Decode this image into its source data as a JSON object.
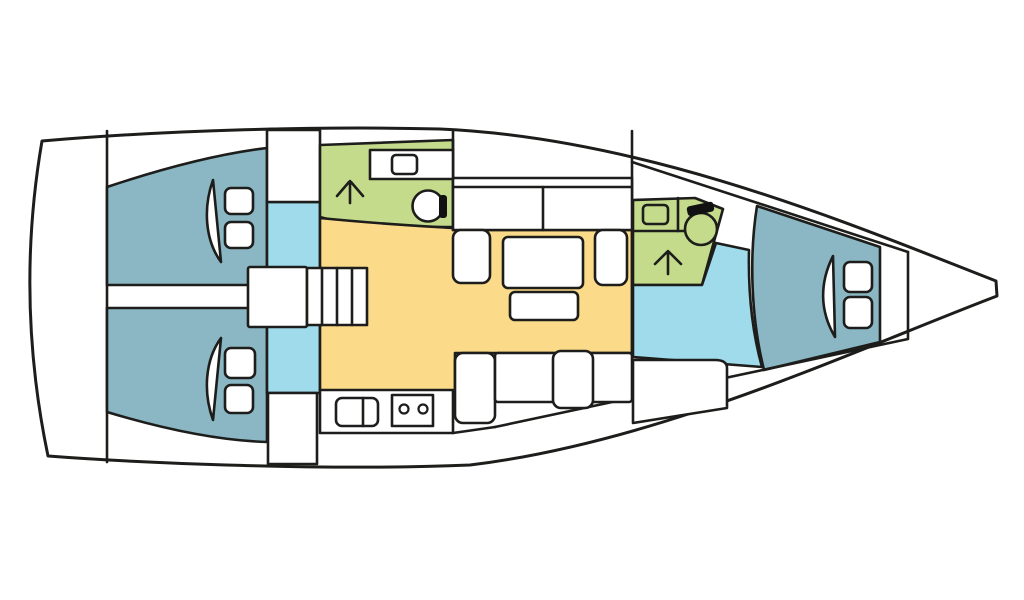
{
  "diagram": {
    "title": "sailboat-interior-layout-top-view",
    "canvas": {
      "width": 1024,
      "height": 600,
      "background": "#ffffff"
    },
    "palette": {
      "line": "#1d1d1b",
      "hull": "#ffffff",
      "cabin": "#8ab7c3",
      "corridor": "#9fdbea",
      "head": "#c4db8c",
      "salon": "#fbda89",
      "fixture": "#ffffff",
      "tank": "#111111"
    },
    "rooms": [
      {
        "name": "aft-cabin-port",
        "fill": "cabin"
      },
      {
        "name": "aft-cabin-starboard",
        "fill": "cabin"
      },
      {
        "name": "forward-cabin",
        "fill": "cabin"
      },
      {
        "name": "aft-head",
        "fill": "head"
      },
      {
        "name": "forward-head",
        "fill": "head"
      },
      {
        "name": "saloon",
        "fill": "salon"
      },
      {
        "name": "companionway-corridor",
        "fill": "corridor"
      },
      {
        "name": "forward-corridor",
        "fill": "corridor"
      }
    ],
    "shapes": [
      {
        "n": "hull-outline",
        "t": "path",
        "f": "hull",
        "w": 3,
        "a": {
          "d": "M 42 141 C 170 130 320 126 440 129 C 650 138 860 228 996 281 L 997 296 C 850 352 660 442 470 465 C 330 471 140 463 48 456 Q 15 298 42 141 Z"
        }
      },
      {
        "n": "stern-bulkhead-line",
        "t": "line",
        "a": {
          "x1": 107,
          "y1": 131,
          "x2": 107,
          "y2": 462
        }
      },
      {
        "n": "aft-cabin-port-area",
        "t": "path",
        "f": "cabin",
        "a": {
          "d": "M 107 187 Q 200 156 267 148 L 267 285 L 107 285 Z"
        }
      },
      {
        "n": "aft-cabin-starboard-area",
        "t": "path",
        "f": "cabin",
        "a": {
          "d": "M 107 412 Q 200 440 267 442 L 267 308 L 107 308 Z"
        }
      },
      {
        "n": "companionway-corridor-area",
        "t": "rect",
        "f": "corridor",
        "a": {
          "x": 267,
          "y": 202,
          "width": 53,
          "height": 191
        }
      },
      {
        "n": "wet-locker-top",
        "t": "rect",
        "f": "hull",
        "a": {
          "x": 267,
          "y": 130,
          "width": 53,
          "height": 72
        }
      },
      {
        "n": "wet-locker-bottom",
        "t": "rect",
        "f": "hull",
        "a": {
          "x": 268,
          "y": 393,
          "width": 49,
          "height": 71
        }
      },
      {
        "n": "aft-head-area",
        "t": "path",
        "f": "head",
        "a": {
          "d": "M 320 145 L 453 140 L 453 227 L 357 227 L 320 217 Z"
        }
      },
      {
        "n": "saloon-area",
        "t": "path",
        "f": "salon",
        "a": {
          "d": "M 320 218 C 380 224 420 226 453 228 L 453 230 L 632 230 L 632 353 L 455 353 L 455 392 L 320 392 Z"
        }
      },
      {
        "n": "forward-head-area",
        "t": "path",
        "f": "head",
        "a": {
          "d": "M 633 200 L 695 198 L 723 209 L 702 285 L 633 285 Z"
        }
      },
      {
        "n": "forward-corridor-area",
        "t": "path",
        "f": "corridor",
        "a": {
          "d": "M 633 285 L 702 285 L 716 243 L 749 250 C 748 295 753 335 762 367 L 633 357 Z"
        }
      },
      {
        "n": "forward-cabin-area",
        "t": "path",
        "f": "cabin",
        "a": {
          "d": "M 757 206 L 880 247 L 880 342 L 764 370 C 751 318 749 256 757 206 Z"
        }
      },
      {
        "n": "deck-line-top",
        "t": "line",
        "a": {
          "x1": 632,
          "y1": 162,
          "x2": 908,
          "y2": 252
        }
      },
      {
        "n": "deck-line-bottom",
        "t": "line",
        "a": {
          "x1": 495,
          "y1": 427,
          "x2": 908,
          "y2": 339
        }
      },
      {
        "n": "deck-line-bottom-joint",
        "t": "line",
        "a": {
          "x1": 453,
          "y1": 433,
          "x2": 495,
          "y2": 427
        }
      },
      {
        "n": "bow-bulkhead-line",
        "t": "line",
        "a": {
          "x1": 908,
          "y1": 252,
          "x2": 908,
          "y2": 338
        }
      },
      {
        "n": "bulkhead-aft-line",
        "t": "line",
        "a": {
          "x1": 453,
          "y1": 131,
          "x2": 453,
          "y2": 178
        }
      },
      {
        "n": "bulkhead-forward-line",
        "t": "line",
        "a": {
          "x1": 632,
          "y1": 131,
          "x2": 632,
          "y2": 357
        }
      },
      {
        "n": "saloon-sofa",
        "t": "rect",
        "f": "fixture",
        "a": {
          "x": 453,
          "y": 178,
          "width": 179,
          "height": 52
        }
      },
      {
        "n": "saloon-sofa-backrest-line",
        "t": "line",
        "a": {
          "x1": 453,
          "y1": 187,
          "x2": 632,
          "y2": 187
        }
      },
      {
        "n": "saloon-sofa-divider-line",
        "t": "line",
        "a": {
          "x1": 543,
          "y1": 187,
          "x2": 543,
          "y2": 230
        }
      },
      {
        "n": "aft-head-counter",
        "t": "rect",
        "f": "fixture",
        "a": {
          "x": 370,
          "y": 150,
          "width": 83,
          "height": 29
        }
      },
      {
        "n": "aft-head-sink",
        "t": "rect",
        "f": "fixture",
        "a": {
          "x": 392,
          "y": 155,
          "width": 25,
          "height": 19,
          "rx": 4
        }
      },
      {
        "n": "aft-head-toilet",
        "t": "circle",
        "f": "fixture",
        "a": {
          "cx": 428,
          "cy": 206,
          "r": 15.5
        }
      },
      {
        "n": "aft-head-toilet-tank",
        "t": "rect",
        "f": "tank",
        "s": "none",
        "a": {
          "x": 439,
          "y": 195,
          "width": 8,
          "height": 23,
          "rx": 3
        }
      },
      {
        "n": "aft-head-shower-arrow",
        "t": "path",
        "f": "none",
        "a": {
          "d": "M 350 203 L 350 181 M 337 196 L 349 182 M 351 182 L 363 196"
        }
      },
      {
        "n": "saloon-table",
        "t": "rect",
        "f": "fixture",
        "a": {
          "x": 503,
          "y": 237,
          "width": 80,
          "height": 51,
          "rx": 5
        }
      },
      {
        "n": "saloon-table-leaf",
        "t": "rect",
        "f": "fixture",
        "a": {
          "x": 510,
          "y": 292,
          "width": 68,
          "height": 28,
          "rx": 5
        }
      },
      {
        "n": "saloon-seat-left",
        "t": "rect",
        "f": "fixture",
        "a": {
          "x": 453,
          "y": 230,
          "width": 37,
          "height": 53,
          "rx": 8
        }
      },
      {
        "n": "saloon-seat-right",
        "t": "rect",
        "f": "fixture",
        "a": {
          "x": 595,
          "y": 230,
          "width": 32,
          "height": 55,
          "rx": 8
        }
      },
      {
        "n": "saloon-seat-bottom",
        "t": "rect",
        "f": "fixture",
        "a": {
          "x": 455,
          "y": 353,
          "width": 40,
          "height": 70,
          "rx": 8
        }
      },
      {
        "n": "saloon-bench-bottom",
        "t": "rect",
        "f": "fixture",
        "a": {
          "x": 495,
          "y": 353,
          "width": 137,
          "height": 49,
          "rx": 3
        }
      },
      {
        "n": "saloon-chair-bottom",
        "t": "rect",
        "f": "fixture",
        "a": {
          "x": 553,
          "y": 351,
          "width": 40,
          "height": 57,
          "rx": 8
        }
      },
      {
        "n": "nav-seat",
        "t": "path",
        "f": "fixture",
        "a": {
          "d": "M 633 360 L 715 360 Q 727 360 727 368 L 727 408 L 633 423 Z"
        }
      },
      {
        "n": "galley-counter",
        "t": "rect",
        "f": "fixture",
        "a": {
          "x": 320,
          "y": 390,
          "width": 133,
          "height": 43
        }
      },
      {
        "n": "galley-sink",
        "t": "rect",
        "f": "fixture",
        "a": {
          "x": 336,
          "y": 398,
          "width": 42,
          "height": 28,
          "rx": 6
        }
      },
      {
        "n": "galley-sink-divider-line",
        "t": "line",
        "a": {
          "x1": 363,
          "y1": 398,
          "x2": 363,
          "y2": 426
        }
      },
      {
        "n": "galley-stove",
        "t": "rect",
        "f": "fixture",
        "a": {
          "x": 392,
          "y": 395,
          "width": 41,
          "height": 31
        }
      },
      {
        "n": "galley-burner-left",
        "t": "circle",
        "f": "fixture",
        "w": 2.2,
        "a": {
          "cx": 404,
          "cy": 409,
          "r": 4.5
        }
      },
      {
        "n": "galley-burner-right",
        "t": "circle",
        "f": "fixture",
        "w": 2.2,
        "a": {
          "cx": 423,
          "cy": 409,
          "r": 4.5
        }
      },
      {
        "n": "companionway-landing",
        "t": "rect",
        "f": "fixture",
        "a": {
          "x": 248,
          "y": 267,
          "width": 59,
          "height": 60,
          "rx": 2
        }
      },
      {
        "n": "companionway-steps",
        "t": "rect",
        "f": "fixture",
        "a": {
          "x": 307,
          "y": 268,
          "width": 60,
          "height": 57
        }
      },
      {
        "n": "companionway-step-line-1",
        "t": "line",
        "a": {
          "x1": 322,
          "y1": 268,
          "x2": 322,
          "y2": 325
        }
      },
      {
        "n": "companionway-step-line-2",
        "t": "line",
        "a": {
          "x1": 337,
          "y1": 268,
          "x2": 337,
          "y2": 325
        }
      },
      {
        "n": "companionway-step-line-3",
        "t": "line",
        "a": {
          "x1": 352,
          "y1": 268,
          "x2": 352,
          "y2": 325
        }
      },
      {
        "n": "port-cabin-pillow-1",
        "t": "rect",
        "f": "fixture",
        "a": {
          "x": 225,
          "y": 188,
          "width": 28,
          "height": 26,
          "rx": 6
        }
      },
      {
        "n": "port-cabin-pillow-2",
        "t": "rect",
        "f": "fixture",
        "a": {
          "x": 225,
          "y": 222,
          "width": 28,
          "height": 26,
          "rx": 6
        }
      },
      {
        "n": "port-cabin-berth-curve",
        "t": "path",
        "f": "fixture",
        "a": {
          "d": "M 213 180 C 203 208 205 240 221 262 Z"
        }
      },
      {
        "n": "starboard-cabin-pillow-1",
        "t": "rect",
        "f": "fixture",
        "a": {
          "x": 225,
          "y": 348,
          "width": 30,
          "height": 30,
          "rx": 6
        }
      },
      {
        "n": "starboard-cabin-pillow-2",
        "t": "rect",
        "f": "fixture",
        "a": {
          "x": 225,
          "y": 385,
          "width": 28,
          "height": 28,
          "rx": 6
        }
      },
      {
        "n": "starboard-cabin-berth-curve",
        "t": "path",
        "f": "fixture",
        "a": {
          "d": "M 213 420 C 203 392 205 360 221 338 Z"
        }
      },
      {
        "n": "forward-cabin-pillow-1",
        "t": "rect",
        "f": "fixture",
        "a": {
          "x": 844,
          "y": 262,
          "width": 28,
          "height": 30,
          "rx": 6
        }
      },
      {
        "n": "forward-cabin-pillow-2",
        "t": "rect",
        "f": "fixture",
        "a": {
          "x": 844,
          "y": 297,
          "width": 28,
          "height": 31,
          "rx": 6
        }
      },
      {
        "n": "forward-cabin-berth-curve",
        "t": "path",
        "f": "fixture",
        "a": {
          "d": "M 833 256 C 820 282 819 310 835 337 Z"
        }
      },
      {
        "n": "forward-head-counter-line-h",
        "t": "line",
        "a": {
          "x1": 633,
          "y1": 231,
          "x2": 687,
          "y2": 231
        }
      },
      {
        "n": "forward-head-counter-line-v",
        "t": "line",
        "a": {
          "x1": 678,
          "y1": 198,
          "x2": 678,
          "y2": 231
        }
      },
      {
        "n": "forward-head-sink",
        "t": "rect",
        "f": "head",
        "a": {
          "x": 643,
          "y": 205,
          "width": 25,
          "height": 19,
          "rx": 4
        }
      },
      {
        "n": "forward-head-toilet",
        "t": "circle",
        "f": "head",
        "a": {
          "cx": 701,
          "cy": 229,
          "r": 16
        }
      },
      {
        "n": "forward-head-toilet-tank",
        "t": "rect",
        "f": "tank",
        "s": "none",
        "a": {
          "x": 687,
          "y": 204,
          "width": 27,
          "height": 10,
          "rx": 3,
          "transform": "rotate(-12 700 209)"
        }
      },
      {
        "n": "forward-head-shower-arrow",
        "t": "path",
        "f": "none",
        "a": {
          "d": "M 668 274 L 668 251 M 655 264 L 667 252 M 669 252 L 681 264"
        }
      }
    ]
  }
}
